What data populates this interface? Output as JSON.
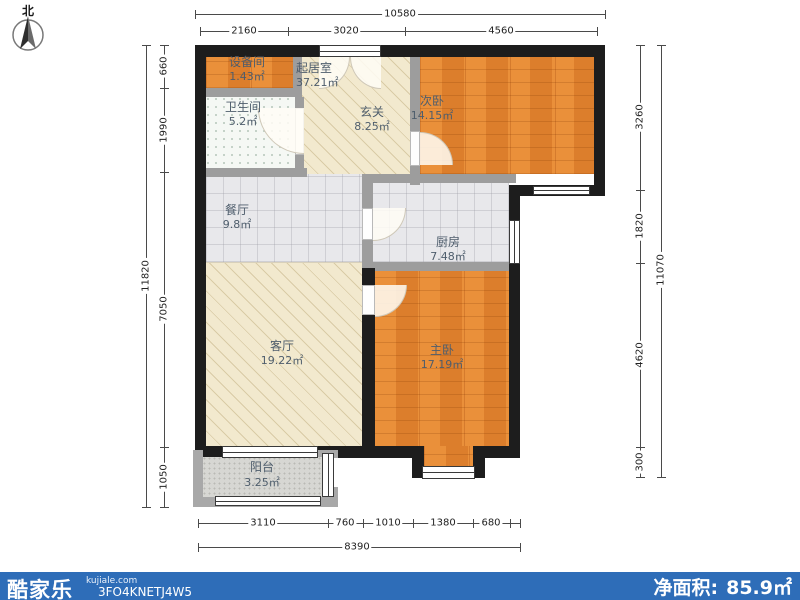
{
  "compass": {
    "label": "北"
  },
  "dimensions": {
    "top": {
      "total": "10580",
      "segments": [
        "2160",
        "3020",
        "4560"
      ]
    },
    "left": {
      "total": "11820",
      "segments": [
        "660",
        "1990",
        "7050",
        "1050"
      ]
    },
    "right": {
      "total": "11070",
      "segments": [
        "3260",
        "1820",
        "4620",
        "300"
      ]
    },
    "bottom": {
      "total": "8390",
      "segments": [
        "3110",
        "760",
        "1010",
        "1380",
        "680"
      ]
    }
  },
  "rooms": {
    "shebeijian": {
      "name": "设备间",
      "area": "1.43㎡"
    },
    "qijushi": {
      "name": "起居室",
      "area": "37.21㎡"
    },
    "weishengjian": {
      "name": "卫生间",
      "area": "5.2㎡"
    },
    "xuanguan": {
      "name": "玄关",
      "area": "8.25㎡"
    },
    "ciwo": {
      "name": "次卧",
      "area": "14.15㎡"
    },
    "canting": {
      "name": "餐厅",
      "area": "9.8㎡"
    },
    "chufang": {
      "name": "厨房",
      "area": "7.48㎡"
    },
    "keting": {
      "name": "客厅",
      "area": "19.22㎡"
    },
    "zhuwo": {
      "name": "主卧",
      "area": "17.19㎡"
    },
    "yangtai": {
      "name": "阳台",
      "area": "3.25㎡"
    }
  },
  "footer": {
    "brand": "酷家乐",
    "domain": "kujiale.com",
    "code": "3FO4KNETJ4W5",
    "net_area_label": "净面积:",
    "net_area_value": "85.9㎡"
  },
  "colors": {
    "exterior_wall": "#1d1d1d",
    "interior_wall": "#9d9d9d",
    "wood_floor": "#e28430",
    "hatch_floor": "#f2e9ce",
    "tile_floor": "#e8e8eb",
    "bath_floor": "#f5f8f4",
    "balcony_floor": "#d7d7d3",
    "footer_bar": "#2e6db8",
    "dim_line": "#4a4a4a",
    "room_label_text": "#4e5d6c"
  }
}
